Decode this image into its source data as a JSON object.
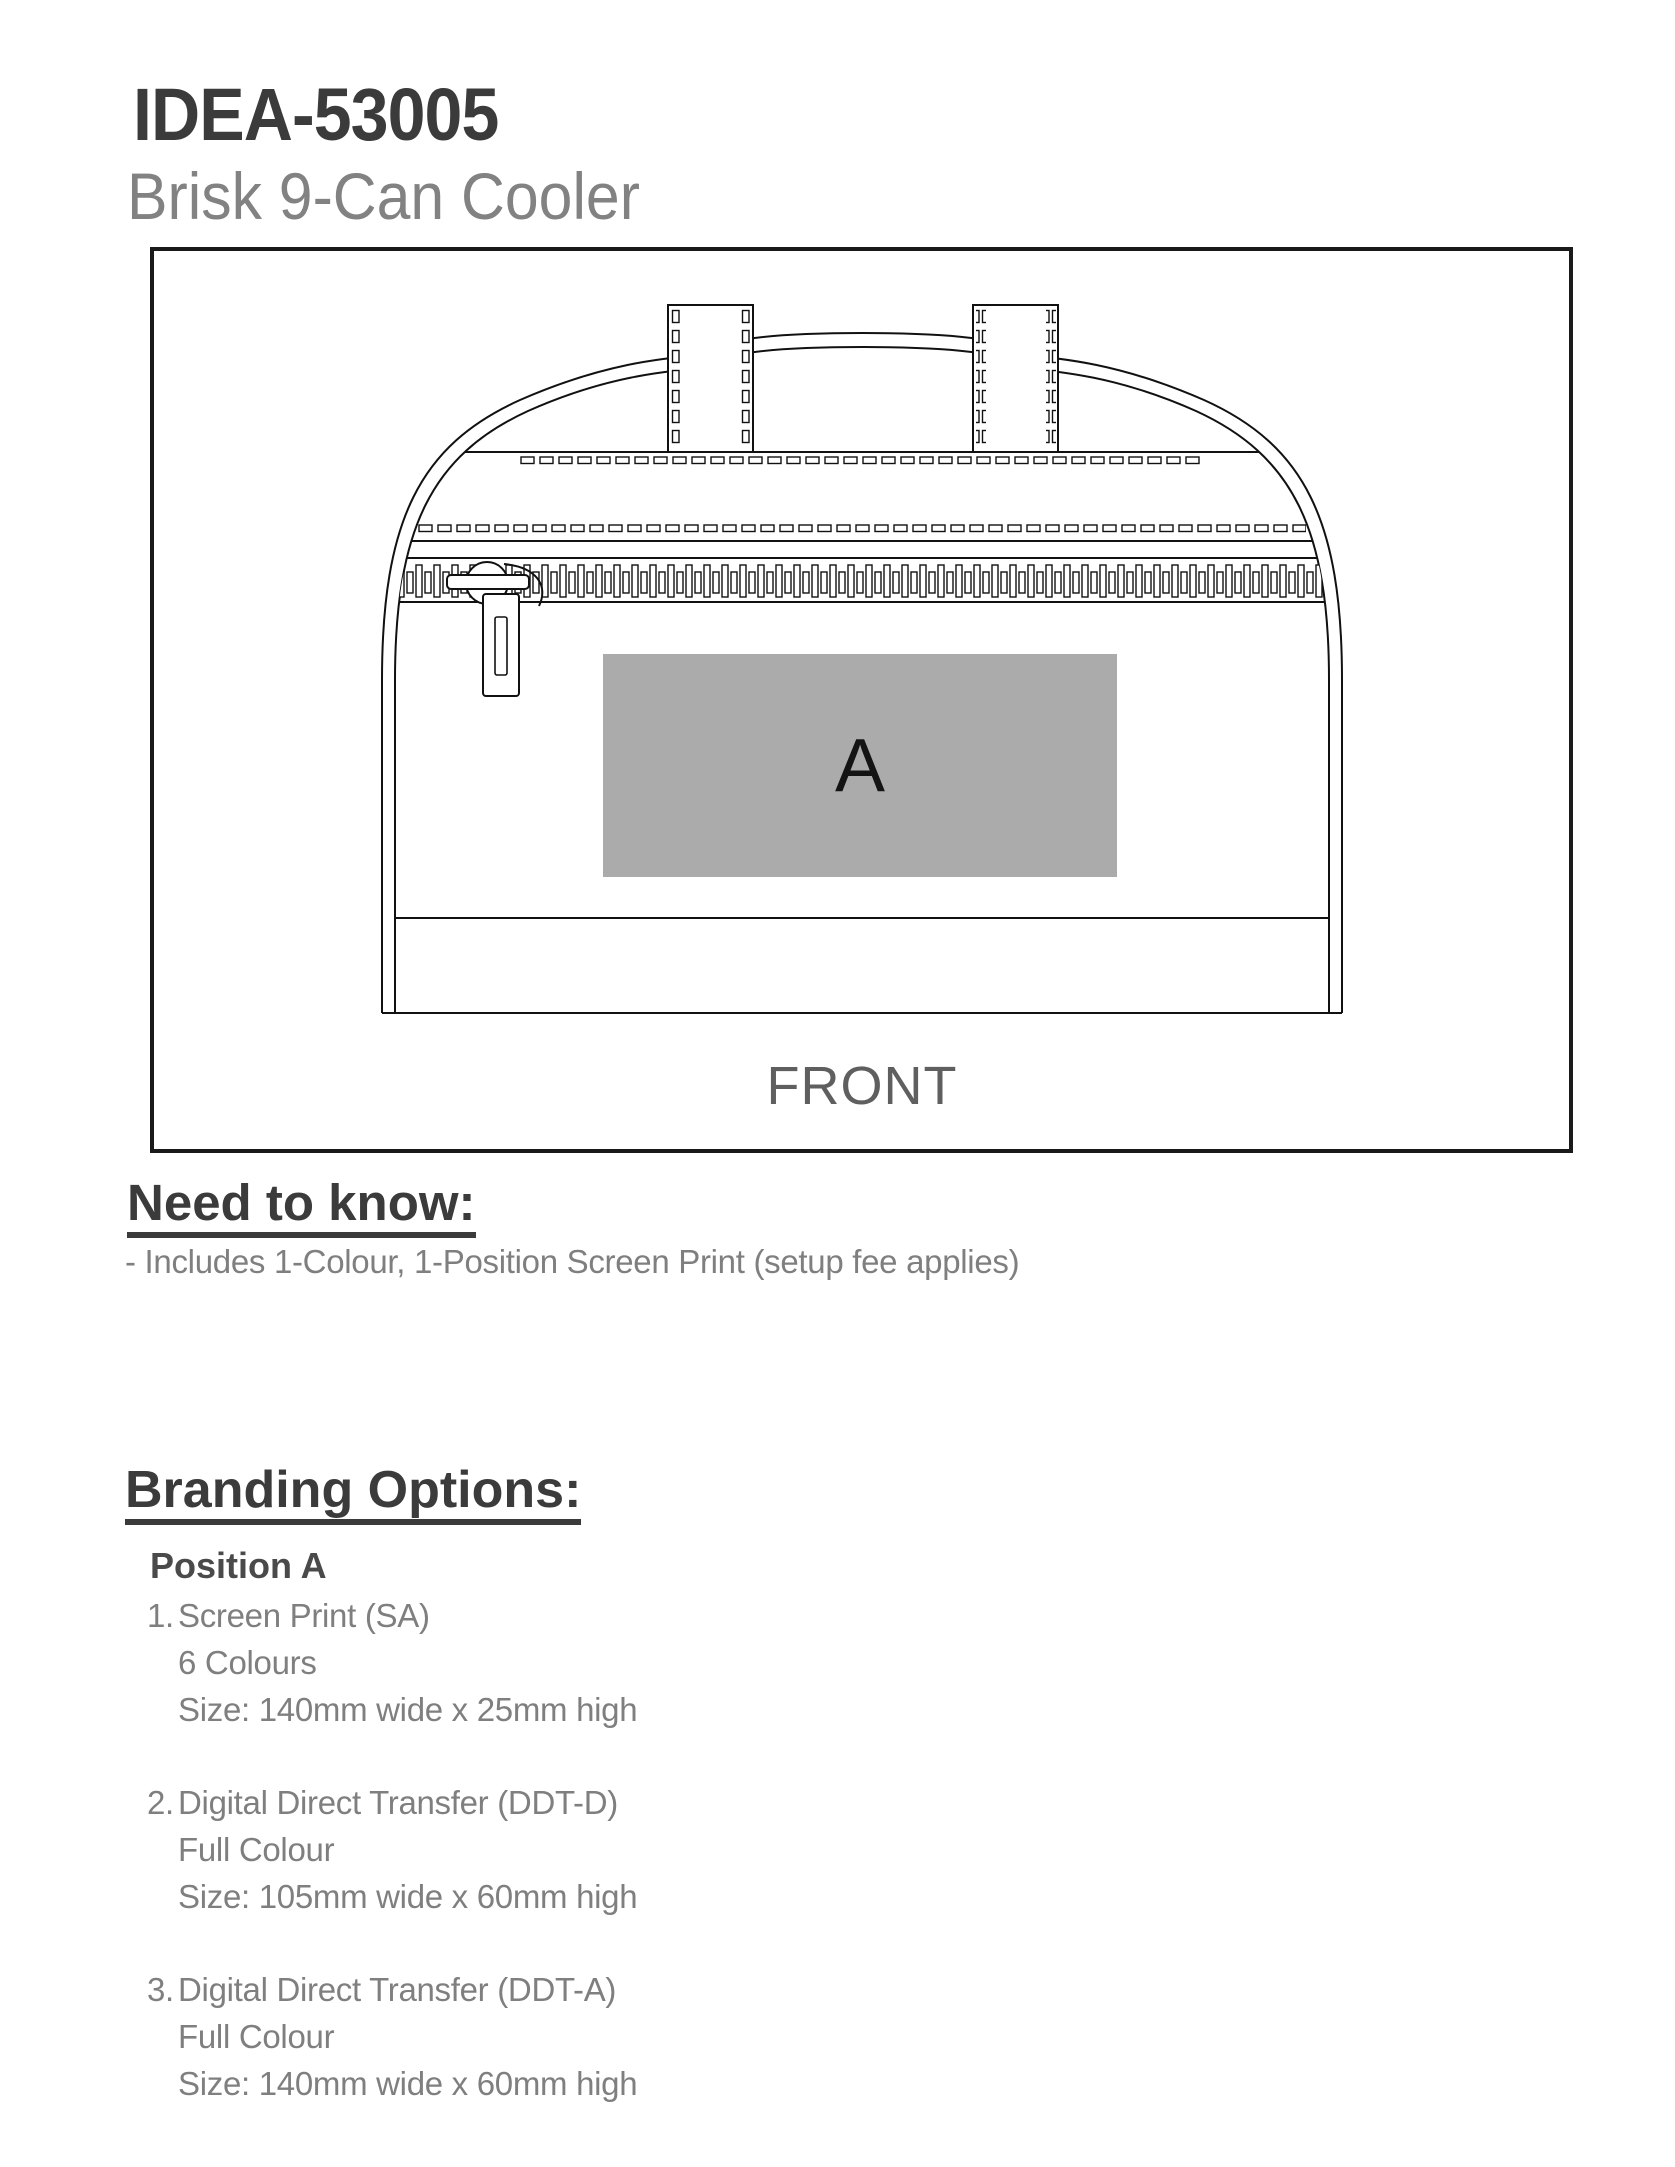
{
  "page": {
    "title": "IDEA-53005",
    "subtitle": "Brisk 9-Can Cooler"
  },
  "diagram": {
    "position_label": "A",
    "view_label": "FRONT"
  },
  "need_to_know": {
    "heading": "Need to know:",
    "note": "- Includes 1-Colour, 1-Position Screen Print (setup fee applies)"
  },
  "branding": {
    "heading": "Branding Options:",
    "position_heading": "Position A",
    "items": [
      {
        "number": "1.",
        "name": "Screen Print (SA)",
        "colours": "6 Colours",
        "size": "Size: 140mm wide x 25mm high"
      },
      {
        "number": "2.",
        "name": "Digital Direct Transfer (DDT-D)",
        "colours": "Full Colour",
        "size": "Size: 105mm wide x 60mm high"
      },
      {
        "number": "3.",
        "name": "Digital Direct Transfer (DDT-A)",
        "colours": "Full Colour",
        "size": "Size: 140mm wide x 60mm high"
      }
    ]
  },
  "colors": {
    "heading_dark": "#3b3b3b",
    "text_gray": "#7f7f7f",
    "subtitle_gray": "#828282",
    "front_label_gray": "#5f5f5f",
    "print_area_gray": "#ababab",
    "line_black": "#111111"
  }
}
